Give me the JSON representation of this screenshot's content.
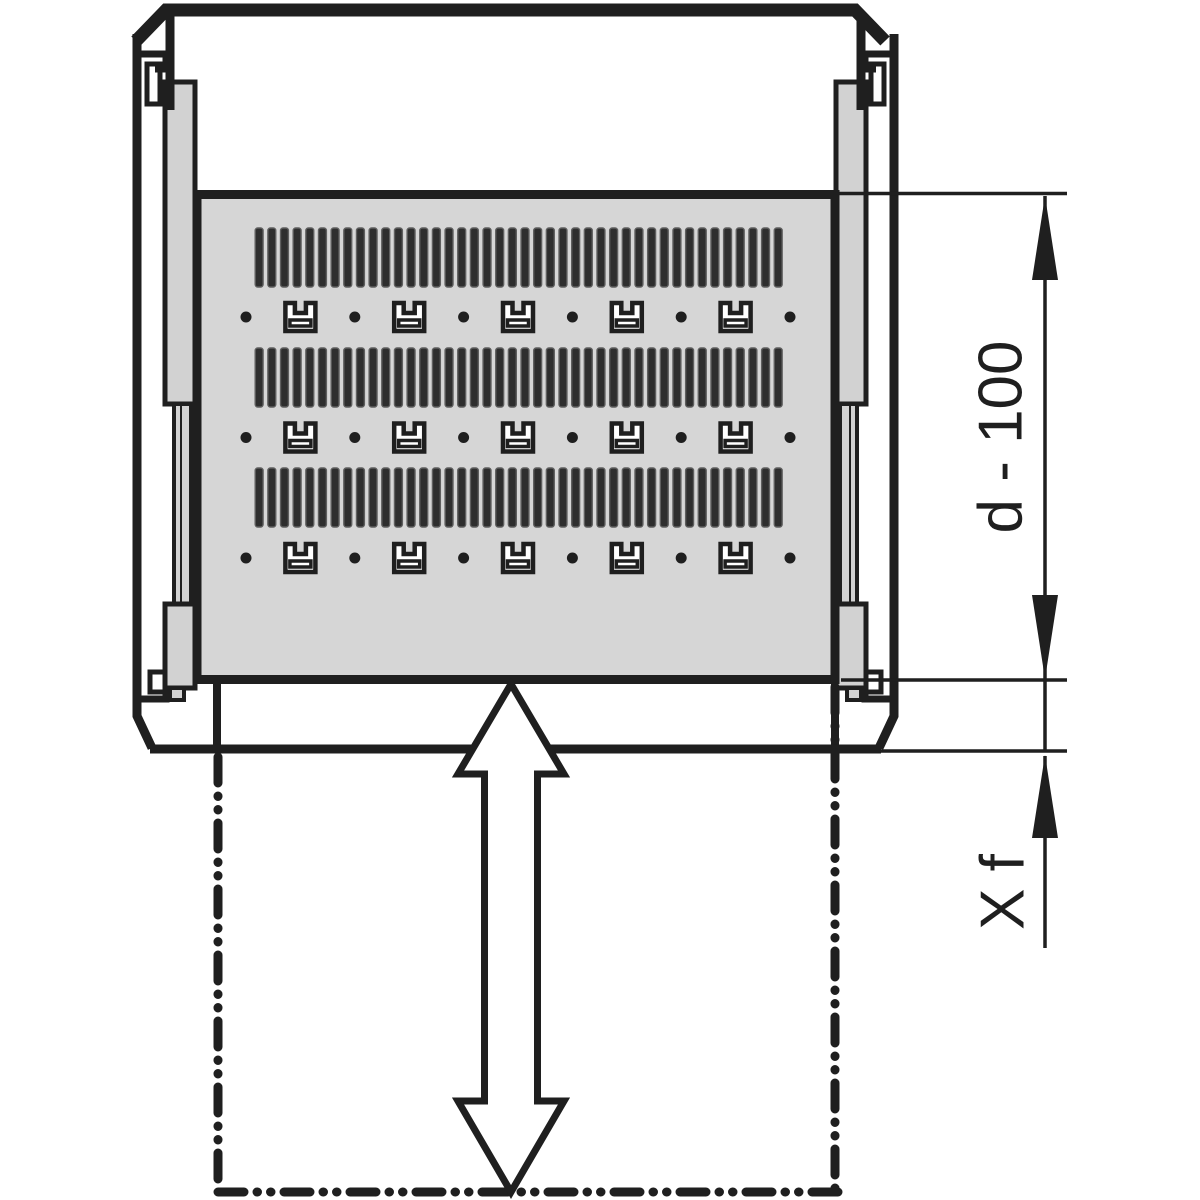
{
  "dimensions": {
    "depth_label": "d - 100",
    "extension_label": "X f"
  },
  "shelf": {
    "vent_rows": 3,
    "slats_per_row": 42,
    "fastener_rows": 3,
    "fastener_dots_per_row": 6,
    "fastener_slots_per_row": 5
  },
  "colors": {
    "line": "#1f1f1f",
    "shelf_fill": "#d6d6d6",
    "rail_fill": "#d2d2d2",
    "slat_fill": "#2e2e2e",
    "slat_edge": "#5f5f5f",
    "background": "#ffffff"
  }
}
